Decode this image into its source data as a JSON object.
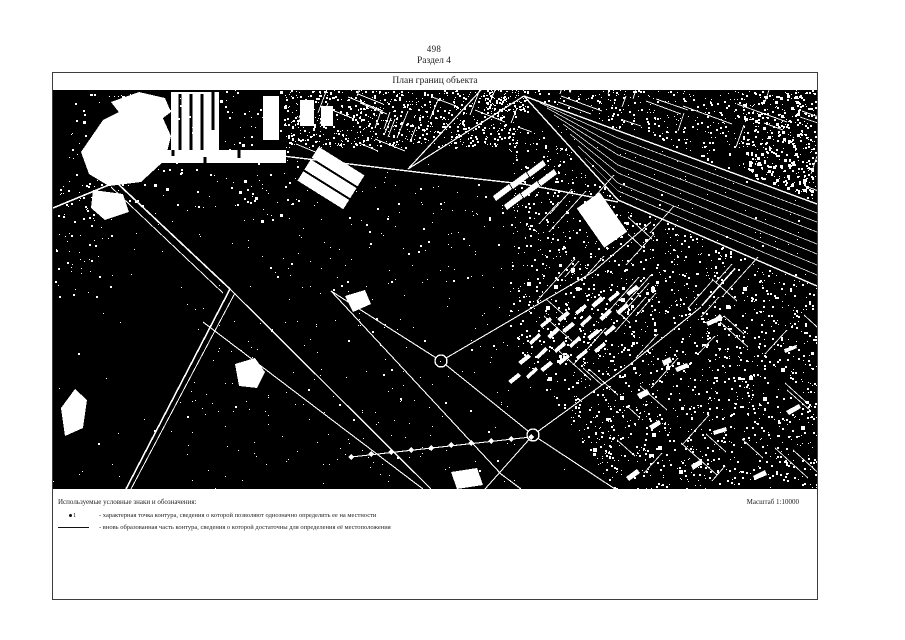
{
  "page": {
    "number": "498",
    "section": "Раздел 4"
  },
  "plan": {
    "title": "План границ объекта",
    "scale": "Масштаб 1:10000"
  },
  "legend": {
    "heading": "Используемые условные знаки и обозначения:",
    "items": [
      {
        "symbol": "characteristic-point",
        "marker": "1",
        "text": "- характерная точка контура, сведения о которой позволяют однозначно определить ее на местности"
      },
      {
        "symbol": "contour-line",
        "text": "- вновь образованная часть контура, сведения о которой достаточны для определения её местоположения"
      }
    ]
  },
  "map": {
    "kind": "binary-satellite-plan",
    "colors": {
      "background": "#000000",
      "features": "#ffffff"
    }
  }
}
